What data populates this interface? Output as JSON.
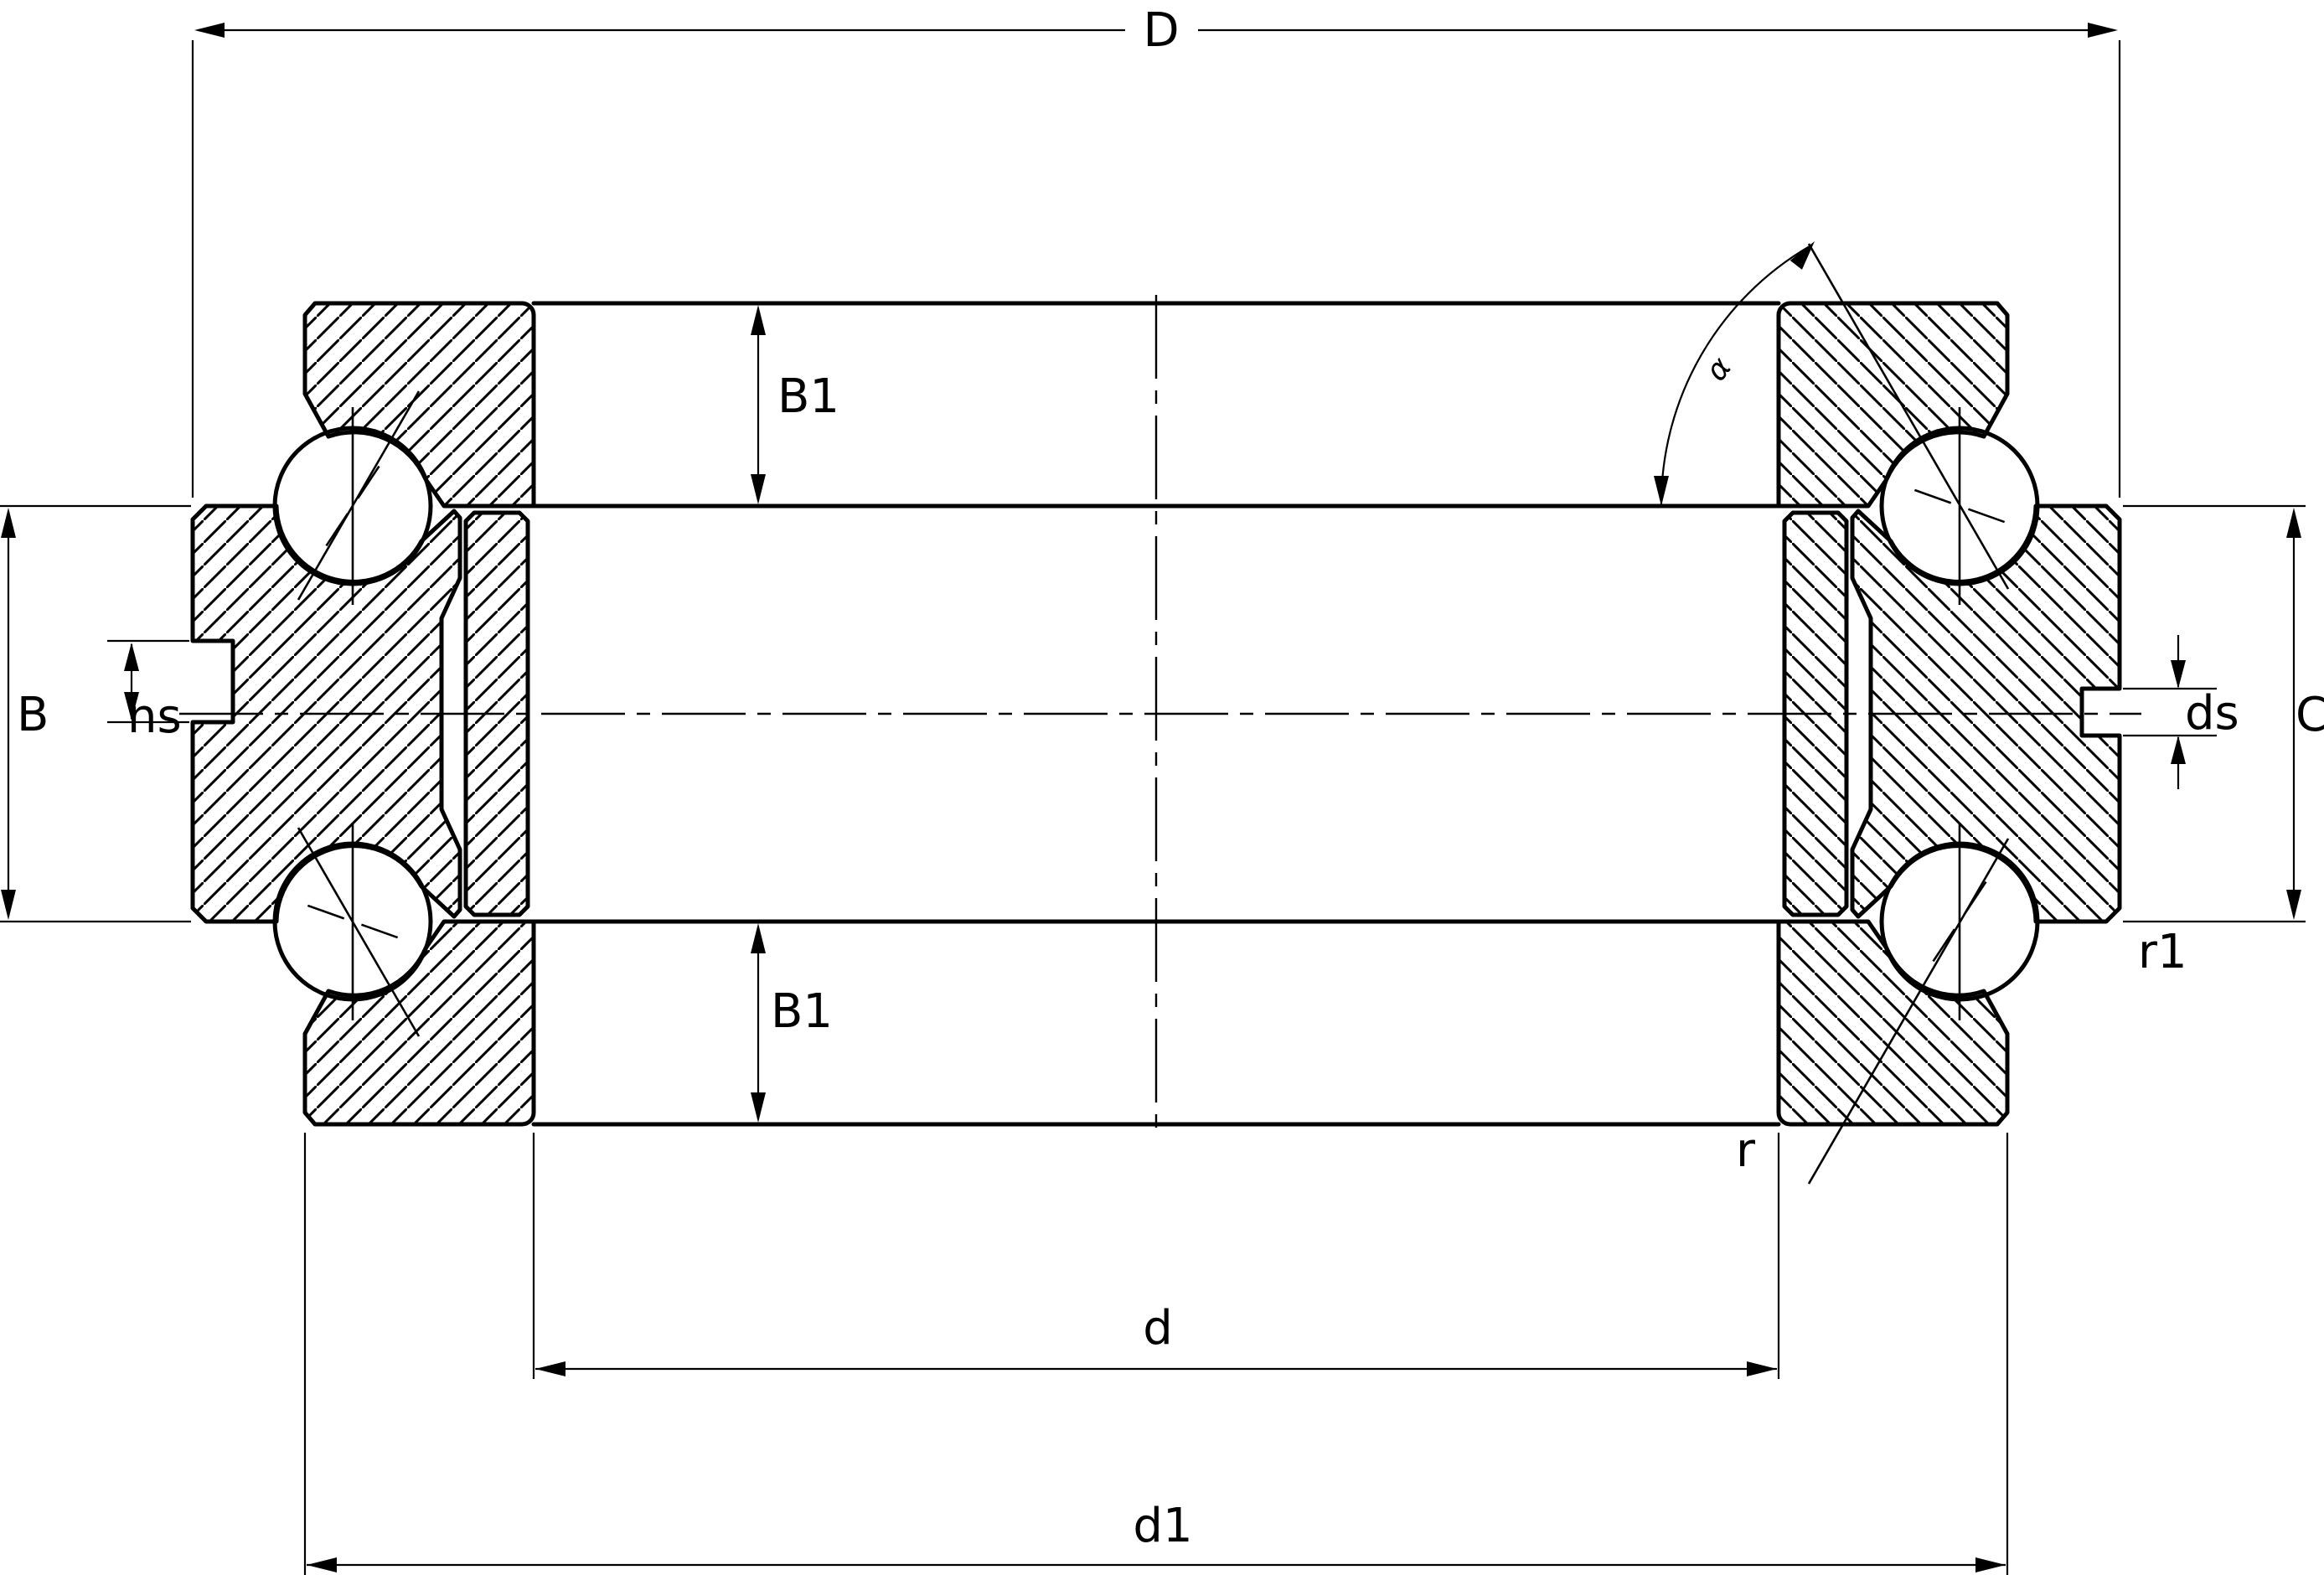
{
  "drawing": {
    "type": "bearing-cross-section",
    "labels": {
      "outer_diameter": "D",
      "row_width_top": "B1",
      "row_width_bottom": "B1",
      "total_width": "B",
      "locating_groove": "ns",
      "locating_groove_dia": "ds",
      "housing_width": "C",
      "fillet_outer": "r1",
      "fillet_bore": "r",
      "bore_diameter": "d",
      "washer_diameter": "d1",
      "contact_angle": "α"
    },
    "colors": {
      "line": "#000000",
      "background": "#ffffff"
    }
  }
}
